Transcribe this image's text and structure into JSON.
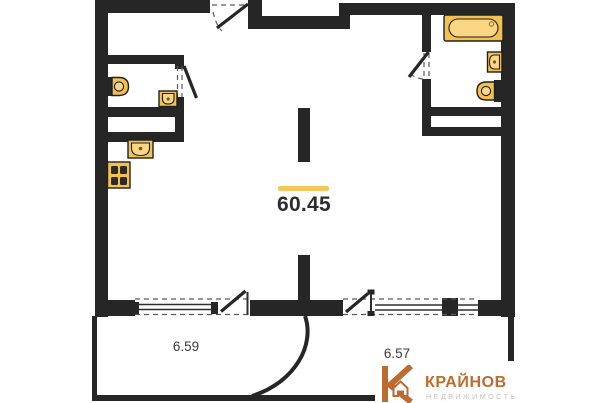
{
  "floor_plan": {
    "main_area": "60.45",
    "balcony_left_area": "6.59",
    "balcony_right_area": "6.57"
  },
  "logo": {
    "brand": "КРАЙНОВ",
    "tagline": "НЕДВИЖИМОСТЬ"
  },
  "fixture_icons": [
    "bathtub-icon",
    "sink-icon",
    "toilet-icon",
    "kitchen-sink-icon",
    "stove-icon"
  ],
  "colors": {
    "wall": "#262626",
    "gold": "#F3C14F",
    "gold2": "#F8D683",
    "accent": "#F6C65B",
    "bronze": "#BE6B2F",
    "gray": "#C6C6C6",
    "label": "#2D2D2D",
    "dash": "#5A5A5A"
  }
}
